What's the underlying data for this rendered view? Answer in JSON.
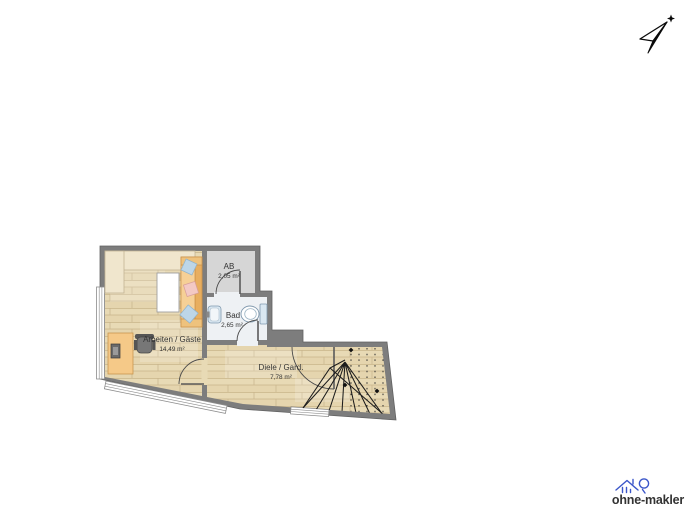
{
  "canvas": {
    "width": 693,
    "height": 520,
    "background": "#ffffff"
  },
  "compass": {
    "icon": "north-arrow"
  },
  "floorplan": {
    "rooms": {
      "arbeiten": {
        "name": "Arbeiten / Gäste",
        "area": "14,49 m²"
      },
      "ab": {
        "name": "AB",
        "area": "2,05 m²"
      },
      "bad": {
        "name": "Bad",
        "area": "2,65 m²"
      },
      "diele": {
        "name": "Diele / Gard.",
        "area": "7,78 m²"
      }
    },
    "colors": {
      "wall": "#7d7d7d",
      "wall_edge": "#616161",
      "wood_floor": "#e8dab5",
      "ab_floor": "#d6d6d6",
      "bad_floor": "#eef1f4",
      "furniture_cream": "#f0e6cd",
      "sofa_orange": "#f2bd73",
      "sofa_seat": "#f6d096",
      "desk_orange": "#f5c988",
      "pillow_blue": "#bdd6e8",
      "pillow_pink": "#f3c9c4",
      "fixture_blue": "#d9e7f1"
    }
  },
  "logo": {
    "text": "ohne-makler",
    "color": "#3b56c9"
  }
}
